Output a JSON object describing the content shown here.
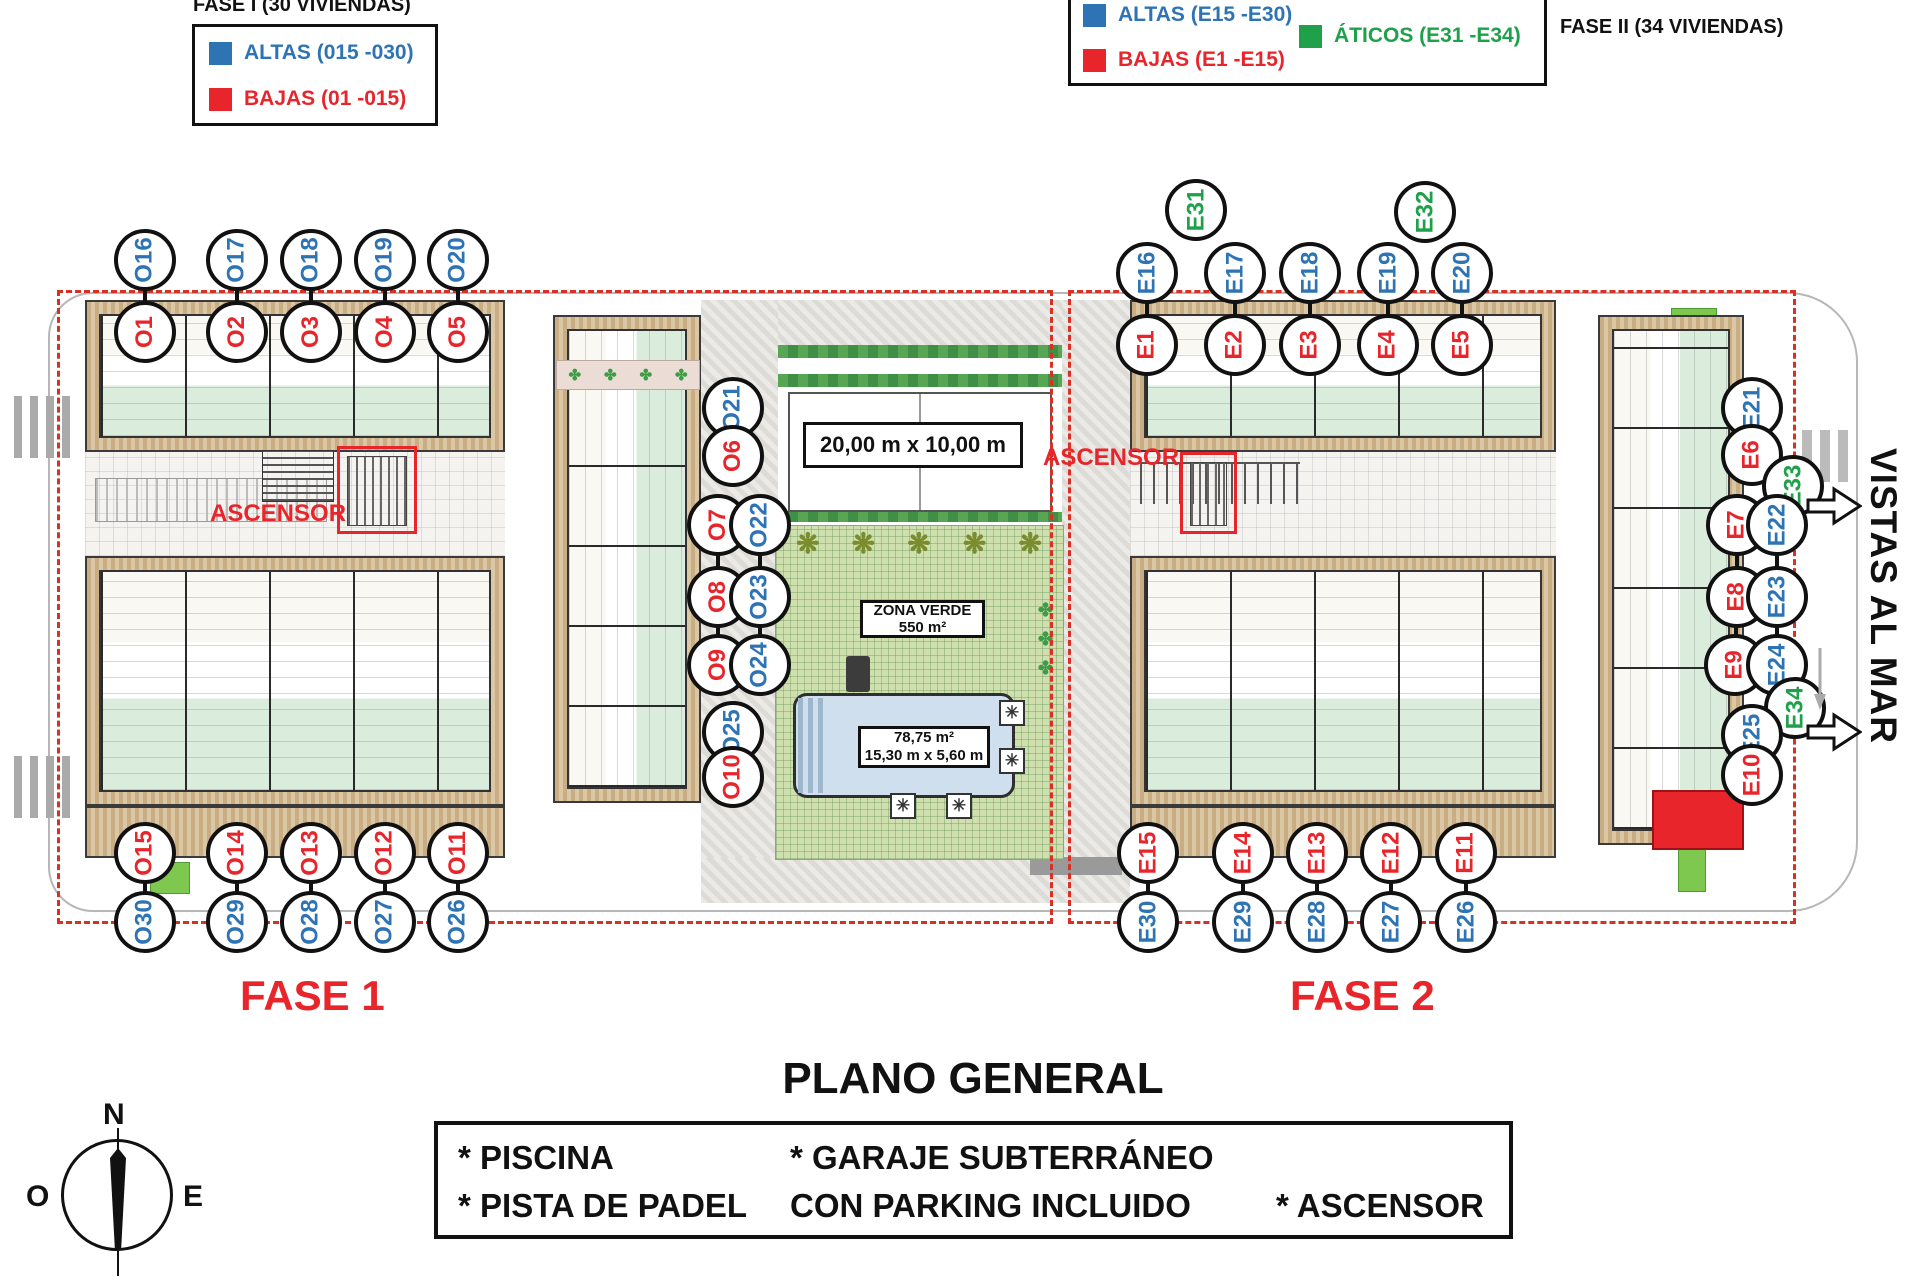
{
  "legends": {
    "fase1": {
      "title": "FASE I (30 VIVIENDAS)",
      "items": [
        {
          "label": "ALTAS (015 -030)",
          "color": "#2e74b5"
        },
        {
          "label": "BAJAS (01 -015)",
          "color": "#e8252b"
        }
      ]
    },
    "fase2": {
      "title": "FASE II (34 VIVIENDAS)",
      "items": [
        {
          "label": "ALTAS (E15 -E30)",
          "color": "#2e74b5"
        },
        {
          "label": "BAJAS (E1 -E15)",
          "color": "#e8252b"
        },
        {
          "label": "ÁTICOS (E31 -E34)",
          "color": "#1fa04a"
        }
      ]
    }
  },
  "plan": {
    "phase1_label": "FASE 1",
    "phase2_label": "FASE 2",
    "ascensor_left": "ASCENSOR",
    "ascensor_right": "ASCENSOR",
    "padel_size": "20,00 m x 10,00 m",
    "zona_verde_line1": "ZONA VERDE",
    "zona_verde_line2": "550 m²",
    "pool_line1": "78,75 m²",
    "pool_line2": "15,30 m x 5,60 m",
    "sea_view": "VISTAS AL MAR"
  },
  "marker_colors": {
    "altas": "#2e74b5",
    "bajas": "#e8252b",
    "aticos": "#1fa04a"
  },
  "unit_markers": [
    {
      "id": "O16",
      "x": 145,
      "y": 260,
      "t": "altas"
    },
    {
      "id": "O17",
      "x": 237,
      "y": 260,
      "t": "altas"
    },
    {
      "id": "O18",
      "x": 311,
      "y": 260,
      "t": "altas"
    },
    {
      "id": "O19",
      "x": 385,
      "y": 260,
      "t": "altas"
    },
    {
      "id": "O20",
      "x": 458,
      "y": 260,
      "t": "altas"
    },
    {
      "id": "O1",
      "x": 145,
      "y": 332,
      "t": "bajas"
    },
    {
      "id": "O2",
      "x": 237,
      "y": 332,
      "t": "bajas"
    },
    {
      "id": "O3",
      "x": 311,
      "y": 332,
      "t": "bajas"
    },
    {
      "id": "O4",
      "x": 385,
      "y": 332,
      "t": "bajas"
    },
    {
      "id": "O5",
      "x": 458,
      "y": 332,
      "t": "bajas"
    },
    {
      "id": "O21",
      "x": 733,
      "y": 408,
      "t": "altas"
    },
    {
      "id": "O6",
      "x": 733,
      "y": 456,
      "t": "bajas"
    },
    {
      "id": "O7",
      "x": 718,
      "y": 525,
      "t": "bajas"
    },
    {
      "id": "O22",
      "x": 760,
      "y": 525,
      "t": "altas"
    },
    {
      "id": "O8",
      "x": 718,
      "y": 597,
      "t": "bajas"
    },
    {
      "id": "O23",
      "x": 760,
      "y": 597,
      "t": "altas"
    },
    {
      "id": "O9",
      "x": 718,
      "y": 665,
      "t": "bajas"
    },
    {
      "id": "O24",
      "x": 760,
      "y": 665,
      "t": "altas"
    },
    {
      "id": "O25",
      "x": 733,
      "y": 732,
      "t": "altas"
    },
    {
      "id": "O10",
      "x": 733,
      "y": 777,
      "t": "bajas"
    },
    {
      "id": "O15",
      "x": 145,
      "y": 853,
      "t": "bajas"
    },
    {
      "id": "O14",
      "x": 237,
      "y": 853,
      "t": "bajas"
    },
    {
      "id": "O13",
      "x": 311,
      "y": 853,
      "t": "bajas"
    },
    {
      "id": "O12",
      "x": 385,
      "y": 853,
      "t": "bajas"
    },
    {
      "id": "O11",
      "x": 458,
      "y": 853,
      "t": "bajas"
    },
    {
      "id": "O30",
      "x": 145,
      "y": 922,
      "t": "altas"
    },
    {
      "id": "O29",
      "x": 237,
      "y": 922,
      "t": "altas"
    },
    {
      "id": "O28",
      "x": 311,
      "y": 922,
      "t": "altas"
    },
    {
      "id": "O27",
      "x": 385,
      "y": 922,
      "t": "altas"
    },
    {
      "id": "O26",
      "x": 458,
      "y": 922,
      "t": "altas"
    },
    {
      "id": "E31",
      "x": 1196,
      "y": 210,
      "t": "aticos"
    },
    {
      "id": "E32",
      "x": 1425,
      "y": 212,
      "t": "aticos"
    },
    {
      "id": "E16",
      "x": 1147,
      "y": 273,
      "t": "altas"
    },
    {
      "id": "E17",
      "x": 1235,
      "y": 273,
      "t": "altas"
    },
    {
      "id": "E18",
      "x": 1310,
      "y": 273,
      "t": "altas"
    },
    {
      "id": "E19",
      "x": 1388,
      "y": 273,
      "t": "altas"
    },
    {
      "id": "E20",
      "x": 1462,
      "y": 273,
      "t": "altas"
    },
    {
      "id": "E1",
      "x": 1147,
      "y": 345,
      "t": "bajas"
    },
    {
      "id": "E2",
      "x": 1235,
      "y": 345,
      "t": "bajas"
    },
    {
      "id": "E3",
      "x": 1310,
      "y": 345,
      "t": "bajas"
    },
    {
      "id": "E4",
      "x": 1388,
      "y": 345,
      "t": "bajas"
    },
    {
      "id": "E5",
      "x": 1462,
      "y": 345,
      "t": "bajas"
    },
    {
      "id": "E21",
      "x": 1752,
      "y": 408,
      "t": "altas"
    },
    {
      "id": "E6",
      "x": 1752,
      "y": 455,
      "t": "bajas"
    },
    {
      "id": "E33",
      "x": 1793,
      "y": 486,
      "t": "aticos"
    },
    {
      "id": "E7",
      "x": 1737,
      "y": 525,
      "t": "bajas"
    },
    {
      "id": "E22",
      "x": 1777,
      "y": 525,
      "t": "altas"
    },
    {
      "id": "E8",
      "x": 1737,
      "y": 597,
      "t": "bajas"
    },
    {
      "id": "E23",
      "x": 1777,
      "y": 597,
      "t": "altas"
    },
    {
      "id": "E9",
      "x": 1735,
      "y": 665,
      "t": "bajas"
    },
    {
      "id": "E24",
      "x": 1777,
      "y": 665,
      "t": "altas"
    },
    {
      "id": "E34",
      "x": 1795,
      "y": 708,
      "t": "aticos"
    },
    {
      "id": "E25",
      "x": 1752,
      "y": 735,
      "t": "altas"
    },
    {
      "id": "E10",
      "x": 1752,
      "y": 775,
      "t": "bajas"
    },
    {
      "id": "E15",
      "x": 1148,
      "y": 853,
      "t": "bajas"
    },
    {
      "id": "E14",
      "x": 1243,
      "y": 853,
      "t": "bajas"
    },
    {
      "id": "E13",
      "x": 1317,
      "y": 853,
      "t": "bajas"
    },
    {
      "id": "E12",
      "x": 1391,
      "y": 853,
      "t": "bajas"
    },
    {
      "id": "E11",
      "x": 1466,
      "y": 853,
      "t": "bajas"
    },
    {
      "id": "E30",
      "x": 1148,
      "y": 922,
      "t": "altas"
    },
    {
      "id": "E29",
      "x": 1243,
      "y": 922,
      "t": "altas"
    },
    {
      "id": "E28",
      "x": 1317,
      "y": 922,
      "t": "altas"
    },
    {
      "id": "E27",
      "x": 1391,
      "y": 922,
      "t": "altas"
    },
    {
      "id": "E26",
      "x": 1466,
      "y": 922,
      "t": "altas"
    }
  ],
  "title": "PLANO GENERAL",
  "amenities": {
    "rows": [
      [
        "* PISCINA",
        "* GARAJE SUBTERRÁNEO",
        ""
      ],
      [
        "* PISTA DE PADEL",
        "CON PARKING INCLUIDO",
        "* ASCENSOR"
      ]
    ]
  },
  "compass": {
    "north": "N",
    "west": "O",
    "east": "E"
  }
}
